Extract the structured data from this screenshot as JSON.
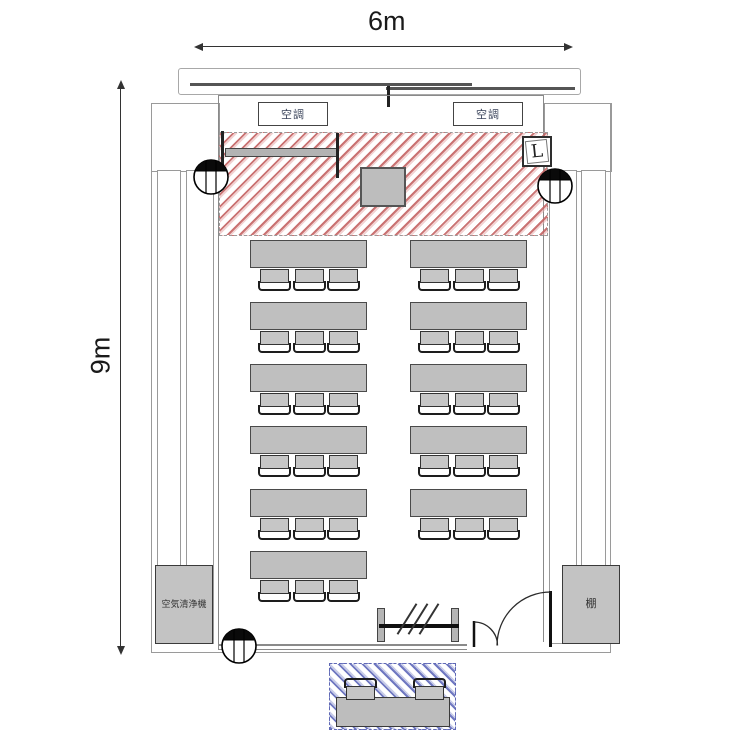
{
  "dimensions": {
    "width_label": "6m",
    "height_label": "9m"
  },
  "labels": {
    "air_conditioner": "空調",
    "air_purifier": "空気清浄機",
    "shelf": "棚",
    "lighting_switch": "L"
  },
  "zones": {
    "stage": {
      "hatch_color": "#c46464",
      "border_style": "dashed"
    },
    "reception": {
      "hatch_color": "#606ab9",
      "border_style": "dashed"
    }
  },
  "seating": {
    "chairs_per_table": 3,
    "rows": [
      {
        "left": true,
        "right": true
      },
      {
        "left": true,
        "right": true
      },
      {
        "left": true,
        "right": true
      },
      {
        "left": true,
        "right": true
      },
      {
        "left": true,
        "right": true
      },
      {
        "left": true,
        "right": false
      }
    ],
    "reception_chairs": 2
  },
  "colors": {
    "furniture": "#c3c3c3",
    "wall": "#8a8a8a"
  }
}
